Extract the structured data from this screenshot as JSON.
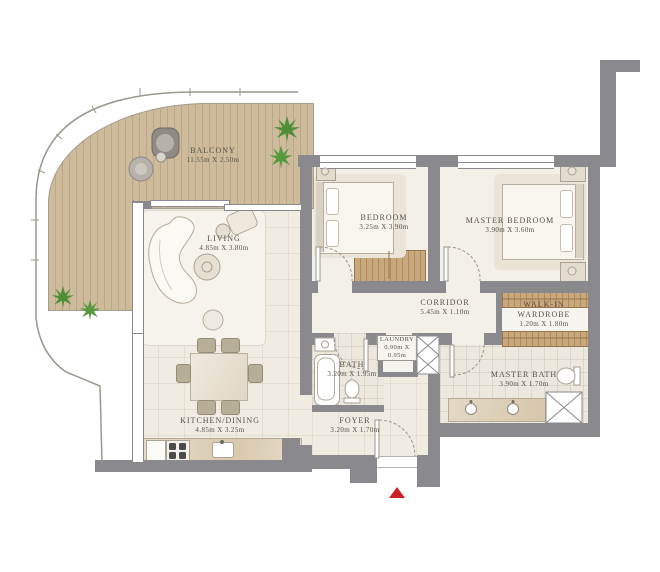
{
  "rooms": {
    "balcony": {
      "name": "BALCONY",
      "dims": "11.55m X 2.50m"
    },
    "living": {
      "name": "LIVING",
      "dims": "4.85m X 3.80m"
    },
    "bedroom": {
      "name": "BEDROOM",
      "dims": "3.25m X 3.90m"
    },
    "master_bedroom": {
      "name": "MASTER BEDROOM",
      "dims": "3.90m X 3.60m"
    },
    "corridor": {
      "name": "CORRIDOR",
      "dims": "5.45m X 1.10m"
    },
    "walk_in": {
      "line1": "WALK-IN",
      "line2": "WARDROBE",
      "dims": "1.20m X 1.80m"
    },
    "bath": {
      "name": "BATH",
      "dims": "3.20m X 1.95m"
    },
    "laundry": {
      "name": "LAUNDRY",
      "dims_line1": "0.90m X",
      "dims_line2": "0.95m"
    },
    "master_bath": {
      "name": "MASTER BATH",
      "dims": "3.90m X 1.70m"
    },
    "kitchen_dining": {
      "name": "KITCHEN/DINING",
      "dims": "4.85m X 3.25m"
    },
    "foyer": {
      "name": "FOYER",
      "dims": "3.20m X 1.70m"
    }
  },
  "colors": {
    "wall_gray": "#8a8a8e",
    "floor_cream": "#f1ede3",
    "deck_wood": "#cdbb9b",
    "wardrobe_wood": "#c8a87d",
    "entrance_red": "#cf2027",
    "plant_green": "#4e8f38"
  },
  "markers": {
    "entrance": "entrance-arrow"
  }
}
